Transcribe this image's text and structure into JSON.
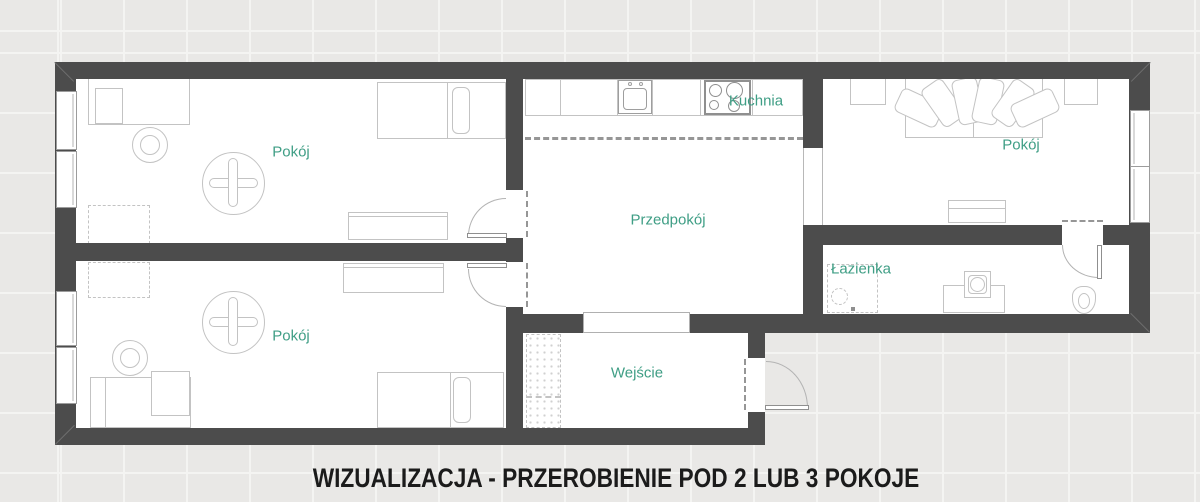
{
  "caption": {
    "text": "WIZUALIZACJA - PRZEROBIENIE POD 2 LUB 3 POKOJE"
  },
  "rooms": {
    "room_top_left": {
      "label": "Pokój"
    },
    "room_bottom_left": {
      "label": "Pokój"
    },
    "room_right": {
      "label": "Pokój"
    },
    "kitchen": {
      "label": "Kuchnia"
    },
    "hallway": {
      "label": "Przedpokój"
    },
    "bathroom": {
      "label": "Łazienka"
    },
    "entrance": {
      "label": "Wejście"
    }
  },
  "colors": {
    "wall": "#4c4c4c",
    "floor": "#ffffff",
    "furniture_line": "#c3c3c3",
    "label": "#3f9e85",
    "caption": "#1b1b1b",
    "outside": "#e9e8e6",
    "grid": "#f4f4f2"
  }
}
